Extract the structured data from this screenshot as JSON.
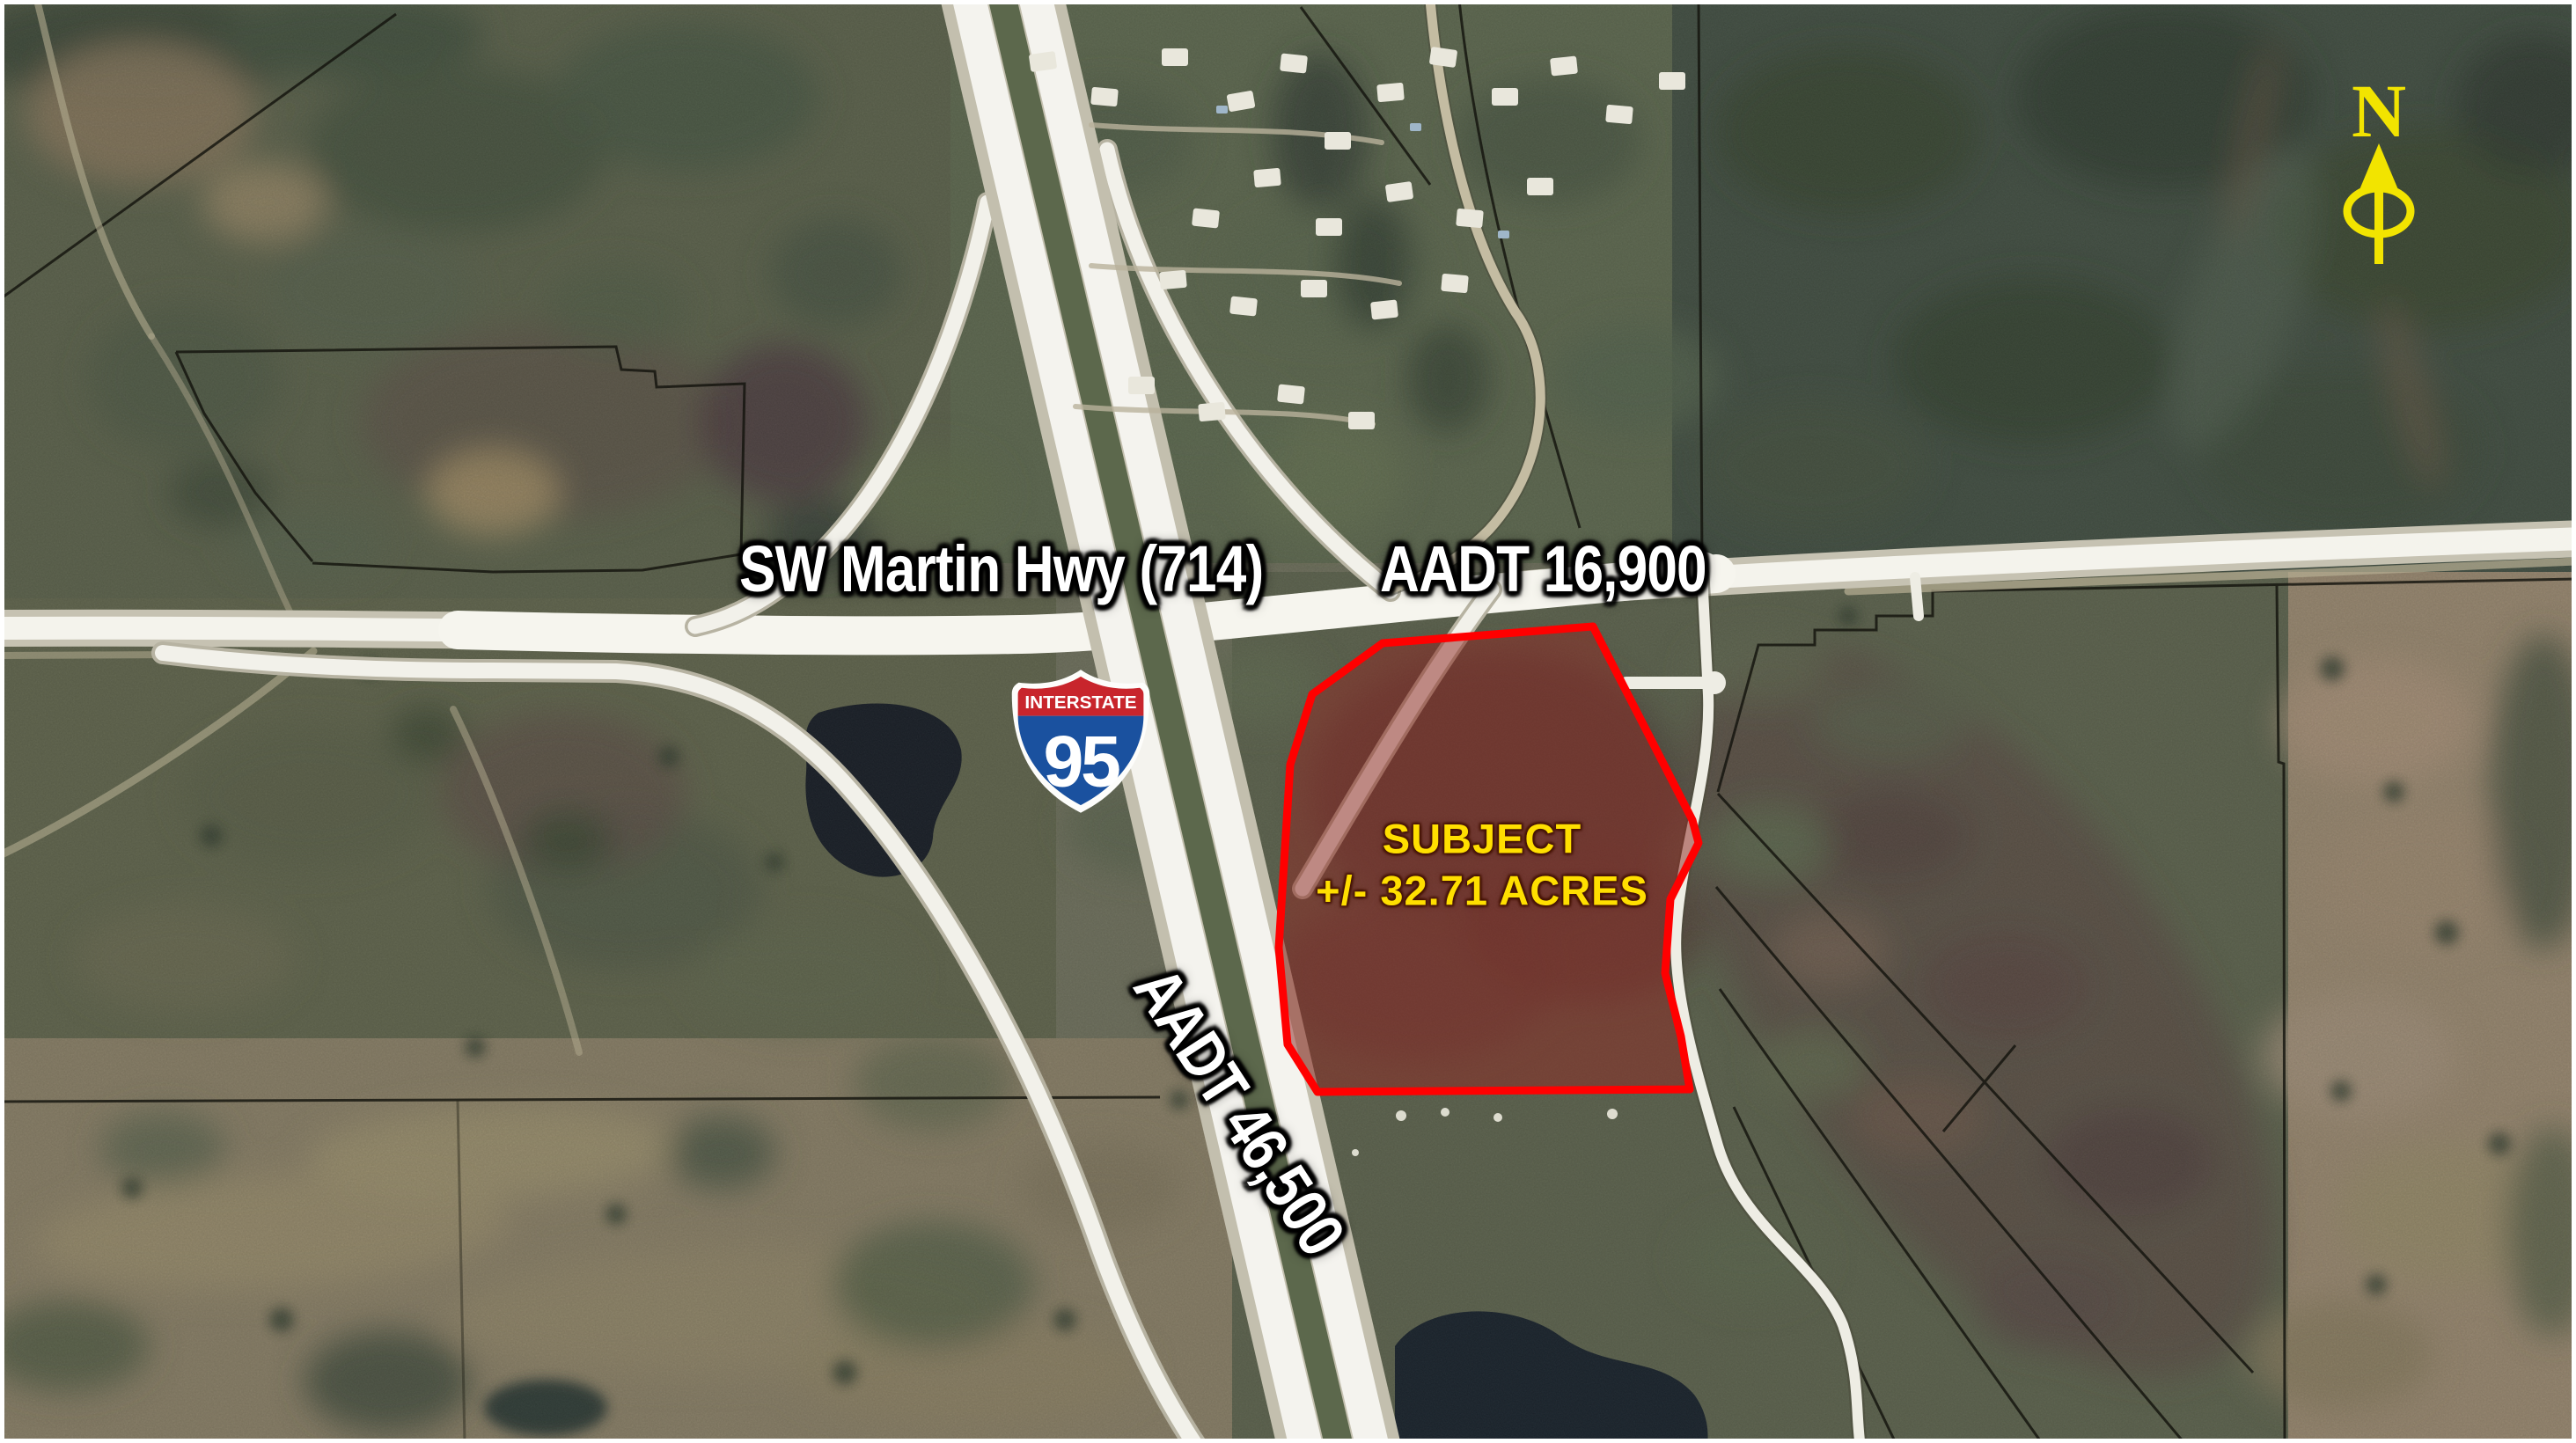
{
  "map_labels": {
    "highway_name": "SW Martin Hwy (714)",
    "highway_aadt": "AADT 16,900",
    "i95_aadt": "AADT 46,500"
  },
  "subject_parcel": {
    "title": "SUBJECT",
    "area": "+/- 32.71 ACRES",
    "outline_color": "#FF0000",
    "fill_color": "#8E2B25",
    "label_color": "#FFDF00"
  },
  "i95_shield": {
    "top_text": "INTERSTATE",
    "route_number": "95",
    "red": "#C8252C",
    "blue": "#1A519F"
  },
  "north_arrow": {
    "label": "N",
    "color": "#F2E400"
  }
}
